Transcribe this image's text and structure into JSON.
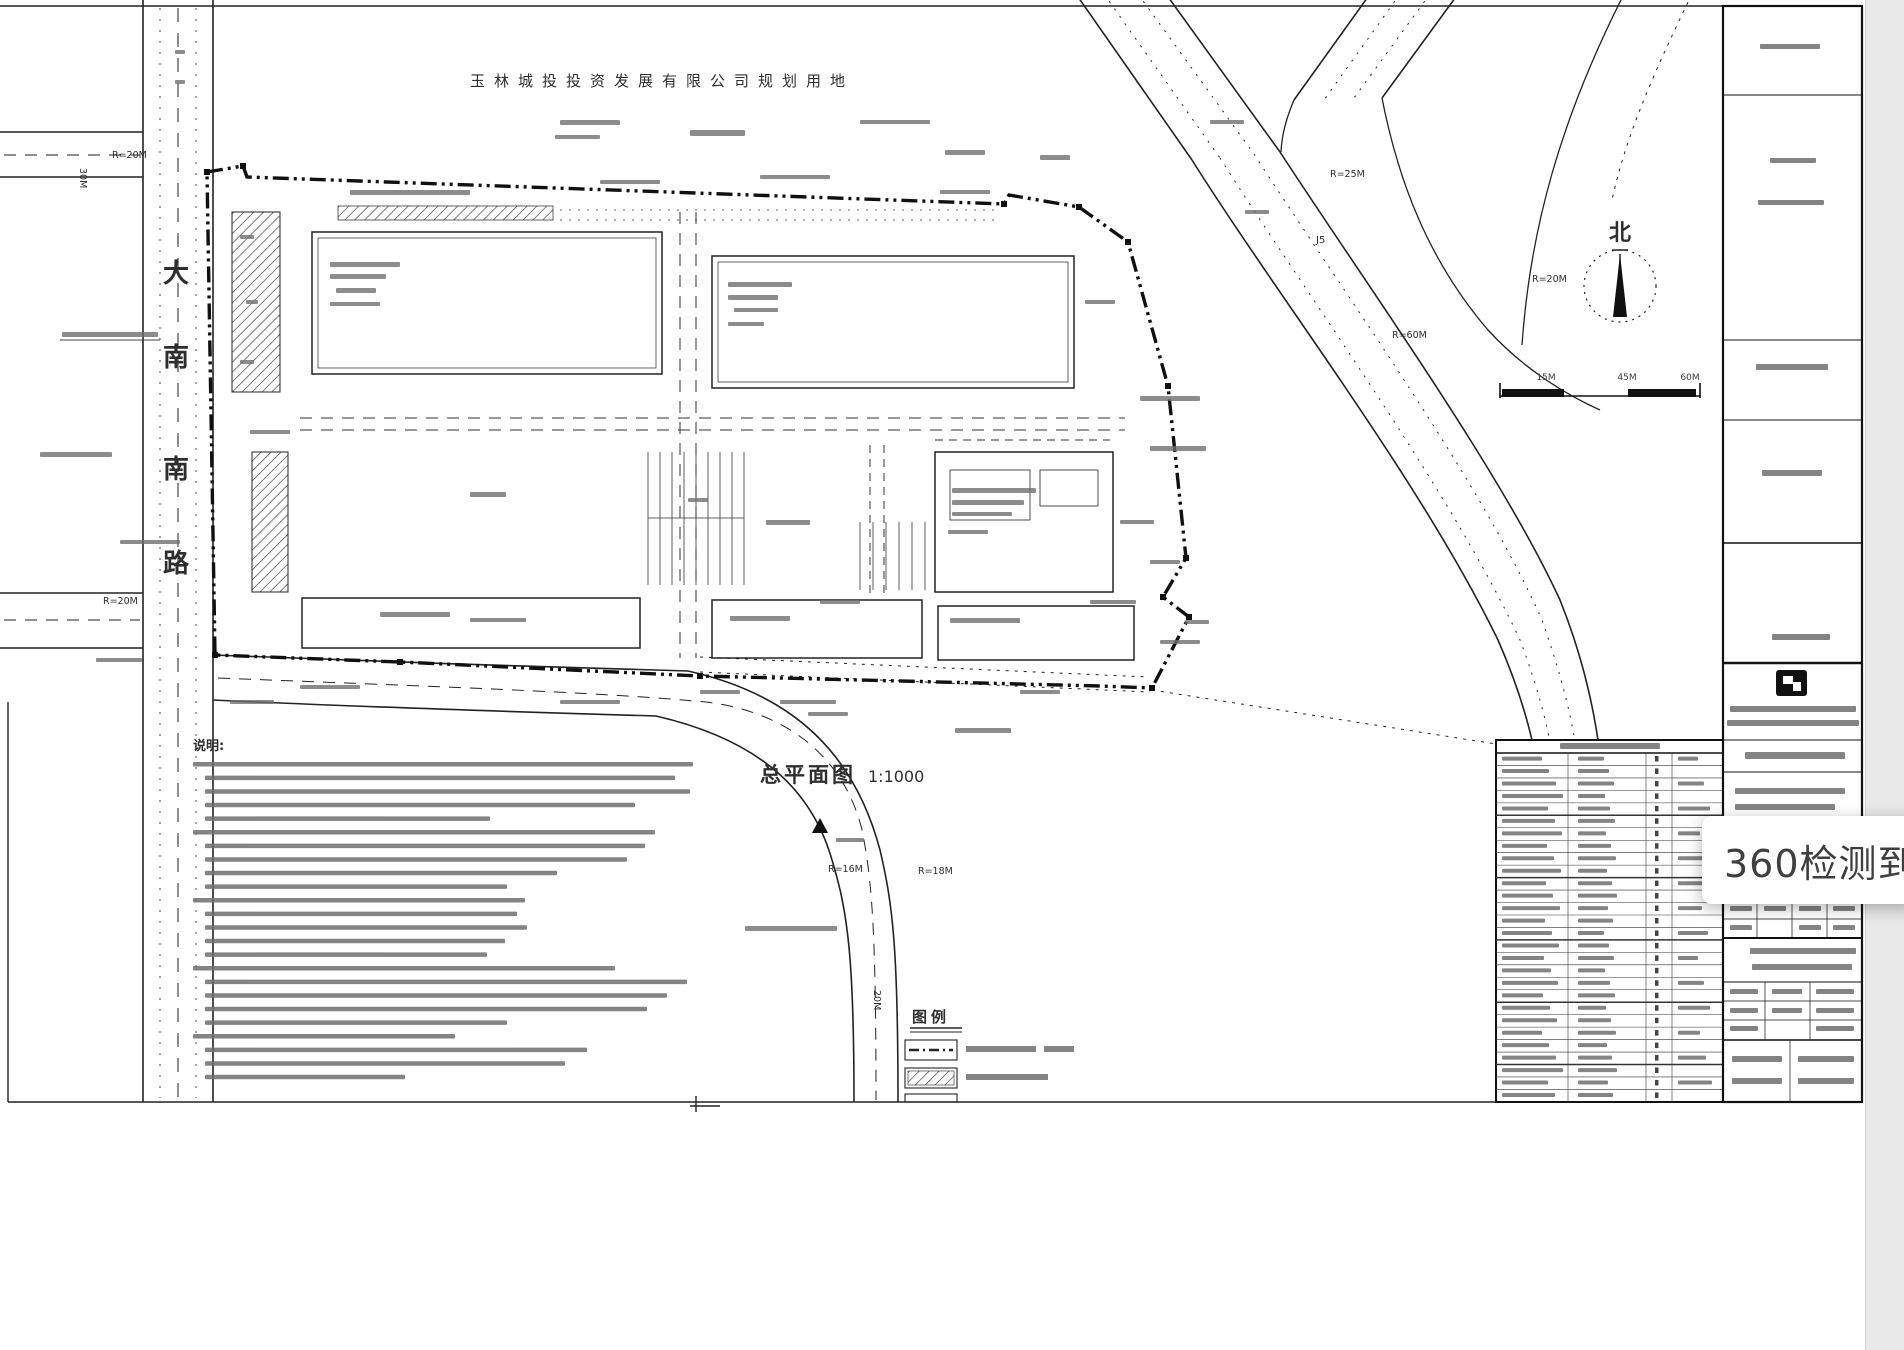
{
  "page": {
    "sheet_bg": "#ffffff",
    "outside_bg": "#e9e9e9"
  },
  "drawing": {
    "top_label": "玉林城投投资发展有限公司规划用地",
    "title": "总平面图",
    "title_scale": "1:1000",
    "north_label": "北",
    "scale_bar_labels": [
      "15M",
      "45M",
      "60M"
    ],
    "road_name_chars": [
      "大",
      "南",
      "南",
      "路"
    ],
    "radius_labels": [
      {
        "text": "R=20M",
        "x": 112,
        "y": 158
      },
      {
        "text": "R=20M",
        "x": 103,
        "y": 604
      },
      {
        "text": "R=25M",
        "x": 1330,
        "y": 177
      },
      {
        "text": "R=60M",
        "x": 1392,
        "y": 338
      },
      {
        "text": "R=20M",
        "x": 1532,
        "y": 282
      },
      {
        "text": "R=16M",
        "x": 828,
        "y": 872
      },
      {
        "text": "R=18M",
        "x": 918,
        "y": 874
      }
    ],
    "dim_labels": [
      {
        "text": "20M",
        "x": 874,
        "y": 990,
        "rot": 90
      },
      {
        "text": "30M",
        "x": 80,
        "y": 168,
        "rot": 90
      }
    ],
    "point_labels": [
      {
        "text": "J5",
        "x": 1316,
        "y": 243
      }
    ],
    "legend_header": "图例",
    "notes_header": "说明:"
  },
  "popup": {
    "text": "360检测到",
    "divider": "|",
    "partial_text": "W",
    "text_color": "#3f3f3f",
    "accent_color": "#2b50c8",
    "bg": "#ffffff"
  }
}
